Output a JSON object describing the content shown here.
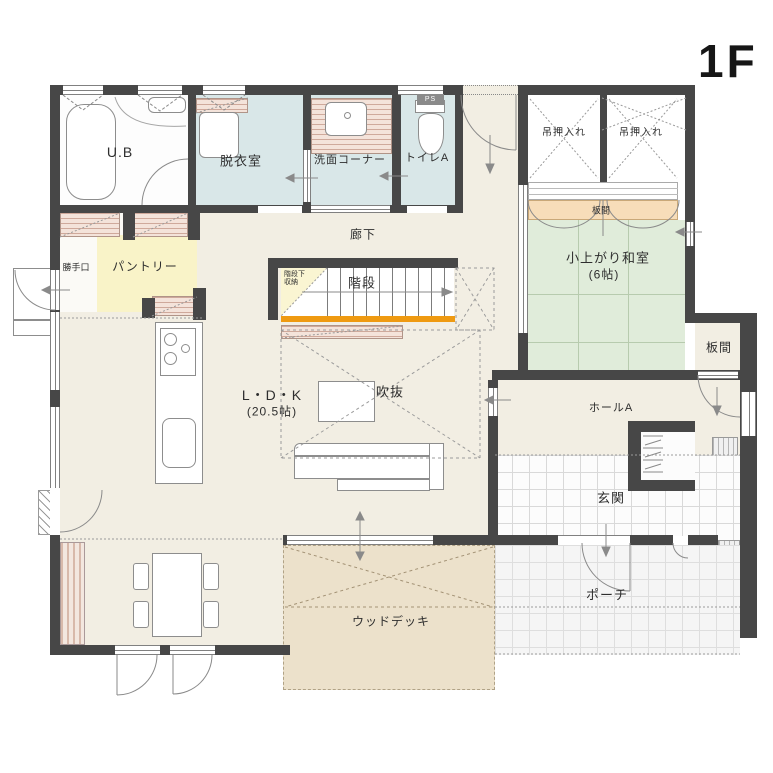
{
  "labels": {
    "floor": "1F",
    "ub": "U.B",
    "dressing_room": "脱衣室",
    "wash_corner": "洗面コーナー",
    "toilet_a": "トイレA",
    "ps": "PS",
    "hallway": "廊下",
    "stairs": "階段",
    "under_stairs_1": "階段下",
    "under_stairs_2": "収納",
    "hanging_closet_left": "吊押入れ",
    "hanging_closet_right": "吊押入れ",
    "itanoma_strip": "板間",
    "tatami_room_name": "小上がり和室",
    "tatami_room_size": "(6帖)",
    "itanoma_room": "板間",
    "hall_a": "ホールA",
    "genkan": "玄関",
    "porch": "ポーチ",
    "pantry": "パントリー",
    "back_door": "勝手口",
    "void": "吹抜",
    "ldk_name": "L・D・K",
    "ldk_size": "(20.5帖)",
    "wood_deck": "ウッドデッキ"
  },
  "colors": {
    "wall": "#474747",
    "floor": "#f2eee3",
    "wet_room": "#d9e7e8",
    "tatami": "#e0ecda",
    "tatami_line": "#b7cbae",
    "pantry": "#f9f3c8",
    "counter_bg": "#f4e3da",
    "counter_line": "#cfa99b",
    "itanoma": "#f7ddb9",
    "deck": "#ece1cb",
    "stair_accent": "#ef9a11",
    "under_stairs": "#faf5d2"
  }
}
